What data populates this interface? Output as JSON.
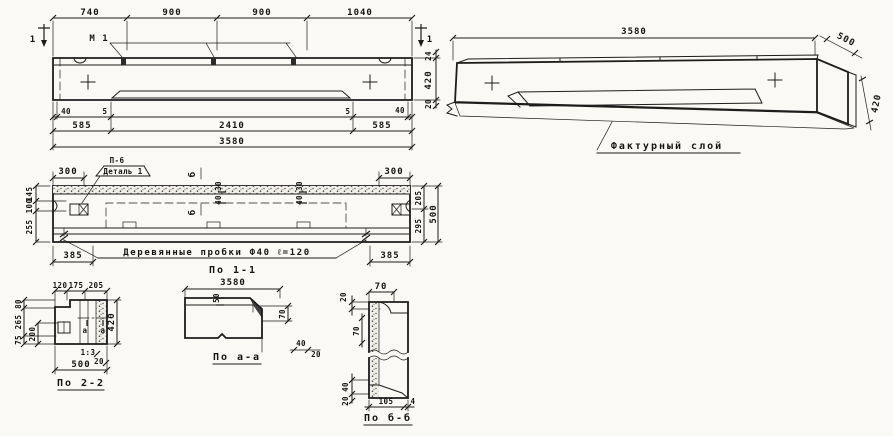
{
  "elevation": {
    "cut_mark": "1",
    "dims_top": [
      "740",
      "900",
      "900",
      "1040"
    ],
    "mark_label": "М 1",
    "dim_ledge": "24",
    "dim_height": "420",
    "dim_layer": "20",
    "dims_row1": [
      "40",
      "5",
      "5",
      "40"
    ],
    "dims_row2": [
      "585",
      "2410",
      "585"
    ],
    "dim_total": "3580"
  },
  "axon": {
    "dim_length": "3580",
    "dim_width": "500",
    "dim_height": "420",
    "callout": "Фактурный слой"
  },
  "plan": {
    "dim_300_left": "300",
    "dim_300_right": "300",
    "detail_tag": "П-6",
    "detail_label": "Деталь 1",
    "section_letter": "б",
    "dim_30": "30",
    "dim_40": "40",
    "plug_note": "Деревянные пробки Ф40 ℓ=120",
    "dim_385_left": "385",
    "dim_385_right": "385",
    "dims_left": [
      "145",
      "100",
      "255"
    ],
    "dims_right": [
      "205",
      "295"
    ],
    "dim_width_total": "500"
  },
  "section_2_2": {
    "dims_top": [
      "120",
      "175",
      "205"
    ],
    "dims_left": [
      "80",
      "265",
      "75"
    ],
    "dim_inner": "200",
    "dim_height": "420",
    "cut_letter": "а",
    "slope": "1:3",
    "dim_20": "20",
    "dim_bottom": "500",
    "caption": "По 2-2"
  },
  "section_1_1": {
    "title": "По 1-1",
    "dim_length": "3580",
    "dim_50": "50",
    "dim_70": "70",
    "dim_40": "40",
    "dim_20": "20",
    "caption": "По а-а"
  },
  "section_b_b": {
    "dim_70_top": "70",
    "dim_20_top": "20",
    "dim_70_inner": "70",
    "dim_40": "40",
    "dim_20_bottom": "20",
    "dim_105": "105",
    "dim_4": "4",
    "caption": "По б-б"
  }
}
